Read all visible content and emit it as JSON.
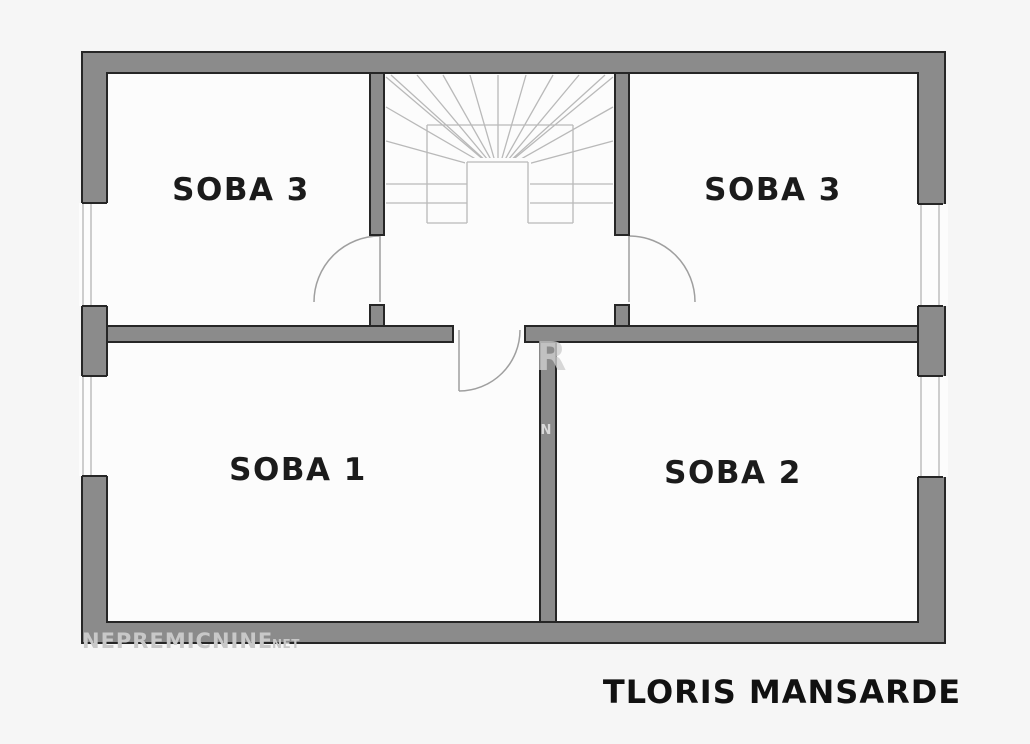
{
  "plan": {
    "rooms": [
      {
        "key": "soba3_left",
        "label": "SOBA 3"
      },
      {
        "key": "soba3_right",
        "label": "SOBA 3"
      },
      {
        "key": "soba1",
        "label": "SOBA 1"
      },
      {
        "key": "soba2",
        "label": "SOBA 2"
      }
    ],
    "caption": "TLORIS MANSARDE",
    "watermark": {
      "main": "NEPREMICNINE",
      "suffix": "NET",
      "center_primary": "R",
      "center_secondary": "N"
    },
    "colors": {
      "wall_fill": "#8b8b8b",
      "wall_outline": "#262626",
      "stair_line": "#b9b9b9",
      "door_line": "#9f9f9f",
      "label_color": "#1b1b1b",
      "watermark_color": "#c8c8c8",
      "background": "#f6f6f6",
      "room_fill": "#fcfcfc"
    }
  }
}
